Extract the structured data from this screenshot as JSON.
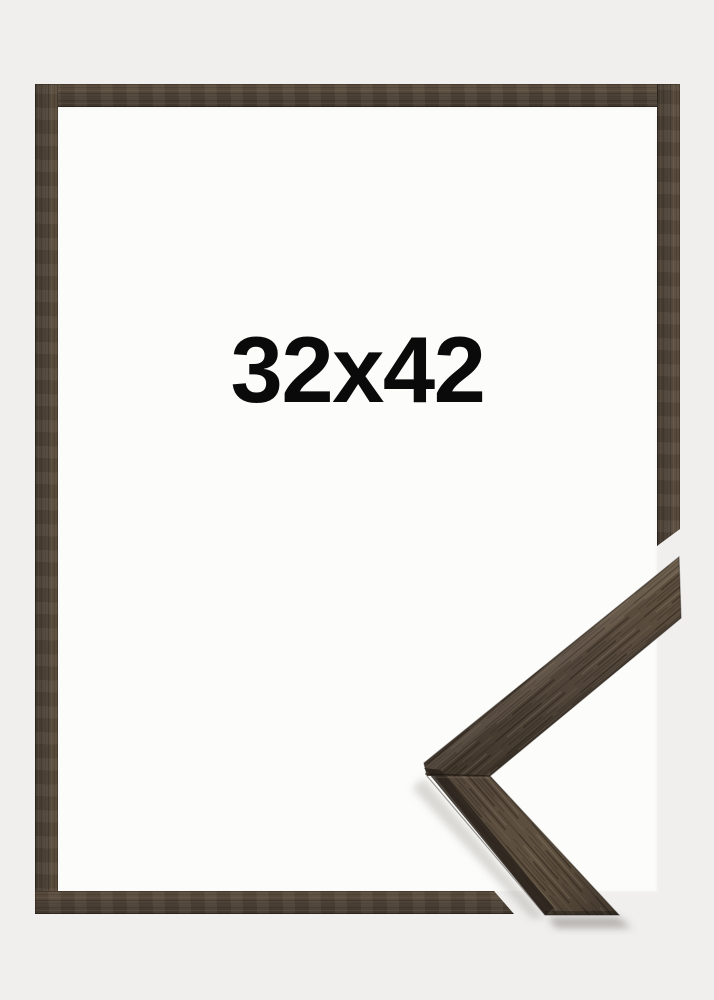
{
  "product": {
    "size_label": "32x42"
  },
  "frame": {
    "material_icon": "wood-grain-texture",
    "parts": {
      "top_bar": "frame-top-moulding",
      "left_bar": "frame-left-moulding",
      "bottom_bar": "frame-bottom-moulding-cut",
      "right_bar": "frame-right-moulding-cut",
      "corner_sample": "frame-corner-profile-sample"
    }
  },
  "colors": {
    "background": "#f0efed",
    "opening": "#fcfcfa",
    "wood_base": "#52463a",
    "wood_light": "#5f5140",
    "wood_dark": "#42382d",
    "wood_bevel": "#2a231c",
    "label_text": "#0a0a0a"
  }
}
